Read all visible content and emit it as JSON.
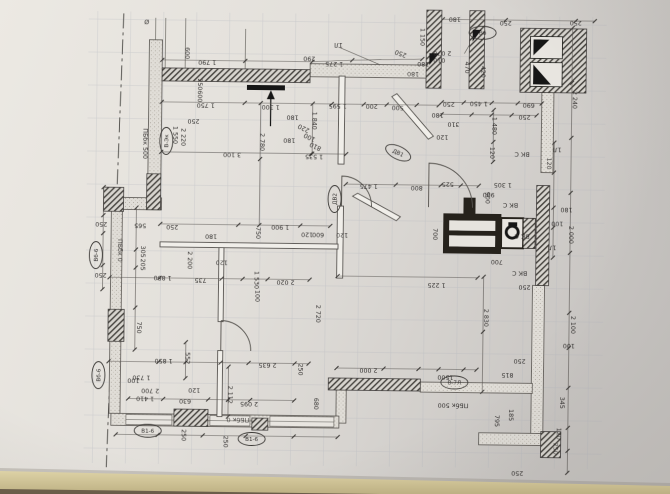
{
  "photo": {
    "paper_color": "#e4e1dc",
    "paper_light": "#efede8",
    "paper_shadow": "#c7c4c0",
    "table_color": "#d6cba0",
    "table_dark": "#b4a779",
    "table_edge_dark": "#5a4c3d",
    "ink": "#3c3a37",
    "grid_color": "#aeb4bb",
    "hatch_color": "#45423e"
  },
  "plan": {
    "dim_labels": [
      {
        "t": "Ø",
        "x": 144,
        "y": 22,
        "r": 180
      },
      {
        "t": "1 790",
        "x": 205,
        "y": 62,
        "r": 180
      },
      {
        "t": "600",
        "x": 183,
        "y": 55,
        "r": 90
      },
      {
        "t": "250",
        "x": 196,
        "y": 86,
        "r": 90
      },
      {
        "t": "600",
        "x": 196,
        "y": 98,
        "r": 90
      },
      {
        "t": "1 750",
        "x": 204,
        "y": 105,
        "r": 180
      },
      {
        "t": "250",
        "x": 192,
        "y": 121,
        "r": 180
      },
      {
        "t": "2 220",
        "x": 180,
        "y": 139,
        "r": 90
      },
      {
        "t": "1 550",
        "x": 172,
        "y": 137,
        "r": 90
      },
      {
        "t": "ПБбк 500",
        "x": 142,
        "y": 146,
        "r": 90
      },
      {
        "t": "290",
        "x": 307,
        "y": 57,
        "r": 180
      },
      {
        "t": "1 275",
        "x": 332,
        "y": 62,
        "r": 180
      },
      {
        "t": "1Л",
        "x": 336,
        "y": 43,
        "r": 180
      },
      {
        "t": "250",
        "x": 399,
        "y": 51,
        "r": 200
      },
      {
        "t": "1 150",
        "x": 418,
        "y": 36,
        "r": 90
      },
      {
        "t": "2 070",
        "x": 440,
        "y": 50,
        "r": 180
      },
      {
        "t": "010",
        "x": 437,
        "y": 57,
        "r": 180
      },
      {
        "t": "180",
        "x": 421,
        "y": 61,
        "r": 180
      },
      {
        "t": "180",
        "x": 411,
        "y": 71,
        "r": 180
      },
      {
        "t": "180",
        "x": 452,
        "y": 16,
        "r": 180
      },
      {
        "t": "250",
        "x": 503,
        "y": 19,
        "r": 180
      },
      {
        "t": "250",
        "x": 573,
        "y": 18,
        "r": 180
      },
      {
        "t": "470",
        "x": 463,
        "y": 66,
        "r": 90
      },
      {
        "t": "420",
        "x": 479,
        "y": 70,
        "r": 90
      },
      {
        "t": "180",
        "x": 436,
        "y": 112,
        "r": 180
      },
      {
        "t": "310",
        "x": 452,
        "y": 121,
        "r": 180
      },
      {
        "t": "120",
        "x": 441,
        "y": 134,
        "r": 180
      },
      {
        "t": "2 240",
        "x": 571,
        "y": 97,
        "r": 90
      },
      {
        "t": "690",
        "x": 527,
        "y": 101,
        "r": 180
      },
      {
        "t": "250",
        "x": 523,
        "y": 113,
        "r": 180
      },
      {
        "t": "1 450",
        "x": 477,
        "y": 100,
        "r": 180
      },
      {
        "t": "250",
        "x": 447,
        "y": 101,
        "r": 180
      },
      {
        "t": "1 480",
        "x": 491,
        "y": 124,
        "r": 90
      },
      {
        "t": "120",
        "x": 489,
        "y": 151,
        "r": 90
      },
      {
        "t": "1Л",
        "x": 556,
        "y": 145,
        "r": 180
      },
      {
        "t": "ВК С",
        "x": 521,
        "y": 150,
        "r": 180
      },
      {
        "t": "120",
        "x": 546,
        "y": 161,
        "r": 90
      },
      {
        "t": "1 595",
        "x": 336,
        "y": 104,
        "r": 180
      },
      {
        "t": "200",
        "x": 370,
        "y": 104,
        "r": 180
      },
      {
        "t": "500",
        "x": 396,
        "y": 105,
        "r": 180
      },
      {
        "t": "1 300",
        "x": 269,
        "y": 106,
        "r": 180
      },
      {
        "t": "180",
        "x": 291,
        "y": 116,
        "r": 180
      },
      {
        "t": "180",
        "x": 288,
        "y": 139,
        "r": 180
      },
      {
        "t": "2 780",
        "x": 259,
        "y": 143,
        "r": 90
      },
      {
        "t": "1 840",
        "x": 311,
        "y": 121,
        "r": 90
      },
      {
        "t": "3 100",
        "x": 231,
        "y": 154,
        "r": 180
      },
      {
        "t": "1 535",
        "x": 313,
        "y": 155,
        "r": 180
      },
      {
        "t": "220",
        "x": 303,
        "y": 127,
        "r": 205
      },
      {
        "t": "100",
        "x": 309,
        "y": 136,
        "r": 205
      },
      {
        "t": "810",
        "x": 315,
        "y": 145,
        "r": 205
      },
      {
        "t": "1 475",
        "x": 368,
        "y": 184,
        "r": 180
      },
      {
        "t": "800",
        "x": 416,
        "y": 185,
        "r": 180
      },
      {
        "t": "525",
        "x": 447,
        "y": 181,
        "r": 180
      },
      {
        "t": "900",
        "x": 485,
        "y": 196,
        "r": 90
      },
      {
        "t": "1 305",
        "x": 502,
        "y": 181,
        "r": 180
      },
      {
        "t": "900",
        "x": 488,
        "y": 191,
        "r": 180
      },
      {
        "t": "ВК С",
        "x": 510,
        "y": 201,
        "r": 180
      },
      {
        "t": "ВК С",
        "x": 522,
        "y": 232,
        "r": 180
      },
      {
        "t": "1Л",
        "x": 552,
        "y": 243,
        "r": 180
      },
      {
        "t": "180",
        "x": 566,
        "y": 205,
        "r": 180
      },
      {
        "t": "100",
        "x": 557,
        "y": 219,
        "r": 180
      },
      {
        "t": "2 000",
        "x": 569,
        "y": 232,
        "r": 90
      },
      {
        "t": "700",
        "x": 433,
        "y": 233,
        "r": 90
      },
      {
        "t": "700",
        "x": 497,
        "y": 258,
        "r": 180
      },
      {
        "t": "ВК С",
        "x": 520,
        "y": 269,
        "r": 180
      },
      {
        "t": "250",
        "x": 525,
        "y": 283,
        "r": 180
      },
      {
        "t": "1 900",
        "x": 280,
        "y": 226,
        "r": 180
      },
      {
        "t": "750",
        "x": 256,
        "y": 234,
        "r": 90
      },
      {
        "t": "120",
        "x": 307,
        "y": 233,
        "r": 180
      },
      {
        "t": "600",
        "x": 318,
        "y": 233,
        "r": 180
      },
      {
        "t": "120",
        "x": 342,
        "y": 233,
        "r": 180
      },
      {
        "t": "180",
        "x": 211,
        "y": 236,
        "r": 180
      },
      {
        "t": "250",
        "x": 101,
        "y": 225,
        "r": 180
      },
      {
        "t": "565",
        "x": 140,
        "y": 226,
        "r": 180
      },
      {
        "t": "250",
        "x": 172,
        "y": 227,
        "r": 180
      },
      {
        "t": "2 200",
        "x": 188,
        "y": 262,
        "r": 90
      },
      {
        "t": "305",
        "x": 141,
        "y": 254,
        "r": 90
      },
      {
        "t": "205",
        "x": 141,
        "y": 267,
        "r": 90
      },
      {
        "t": "ПБбк 0",
        "x": 118,
        "y": 253,
        "r": 90
      },
      {
        "t": "250",
        "x": 101,
        "y": 276,
        "r": 180
      },
      {
        "t": "1 850",
        "x": 163,
        "y": 278,
        "r": 180
      },
      {
        "t": "735",
        "x": 201,
        "y": 280,
        "r": 180
      },
      {
        "t": "120",
        "x": 222,
        "y": 262,
        "r": 180
      },
      {
        "t": "1 530",
        "x": 255,
        "y": 281,
        "r": 90
      },
      {
        "t": "2 020",
        "x": 286,
        "y": 281,
        "r": 180
      },
      {
        "t": "2 720",
        "x": 317,
        "y": 314,
        "r": 90
      },
      {
        "t": "750",
        "x": 138,
        "y": 330,
        "r": 90
      },
      {
        "t": "100",
        "x": 256,
        "y": 297,
        "r": 90
      },
      {
        "t": "1 850",
        "x": 165,
        "y": 361,
        "r": 180
      },
      {
        "t": "552",
        "x": 187,
        "y": 360,
        "r": 90
      },
      {
        "t": "2 635",
        "x": 269,
        "y": 364,
        "r": 180
      },
      {
        "t": "250",
        "x": 300,
        "y": 370,
        "r": 90
      },
      {
        "t": "100",
        "x": 135,
        "y": 381,
        "r": 180
      },
      {
        "t": "1 730",
        "x": 143,
        "y": 378,
        "r": 180
      },
      {
        "t": "2 700",
        "x": 152,
        "y": 391,
        "r": 180
      },
      {
        "t": "1 410",
        "x": 147,
        "y": 399,
        "r": 180
      },
      {
        "t": "120",
        "x": 196,
        "y": 390,
        "r": 180
      },
      {
        "t": "630",
        "x": 187,
        "y": 401,
        "r": 180
      },
      {
        "t": "2 112",
        "x": 230,
        "y": 396,
        "r": 90
      },
      {
        "t": "2 095",
        "x": 251,
        "y": 403,
        "r": 180
      },
      {
        "t": "680",
        "x": 316,
        "y": 404,
        "r": 90
      },
      {
        "t": "ПБбк 0",
        "x": 240,
        "y": 419,
        "r": 180
      },
      {
        "t": "250",
        "x": 184,
        "y": 437,
        "r": 90
      },
      {
        "t": "250",
        "x": 226,
        "y": 443,
        "r": 90
      },
      {
        "t": "1 225",
        "x": 437,
        "y": 282,
        "r": 180
      },
      {
        "t": "2 830",
        "x": 485,
        "y": 316,
        "r": 90
      },
      {
        "t": "2 000",
        "x": 370,
        "y": 368,
        "r": 180
      },
      {
        "t": "1500",
        "x": 447,
        "y": 374,
        "r": 180
      },
      {
        "t": "815",
        "x": 509,
        "y": 371,
        "r": 180
      },
      {
        "t": "250",
        "x": 521,
        "y": 357,
        "r": 180
      },
      {
        "t": "ПБбк 500",
        "x": 455,
        "y": 402,
        "r": 180
      },
      {
        "t": "795",
        "x": 497,
        "y": 419,
        "r": 90
      },
      {
        "t": "185",
        "x": 511,
        "y": 413,
        "r": 90
      },
      {
        "t": "2 100",
        "x": 572,
        "y": 322,
        "r": 90
      },
      {
        "t": "100",
        "x": 570,
        "y": 341,
        "r": 180
      },
      {
        "t": "345",
        "x": 562,
        "y": 400,
        "r": 90
      },
      {
        "t": "120",
        "x": 559,
        "y": 431,
        "r": 90
      },
      {
        "t": "250",
        "x": 556,
        "y": 446,
        "r": 90
      },
      {
        "t": "250",
        "x": 520,
        "y": 469,
        "r": 180
      }
    ],
    "axis_tags": [
      {
        "t": "В-Эк",
        "x": 165,
        "y": 143,
        "r": 90
      },
      {
        "t": "Вб",
        "x": 480,
        "y": 31,
        "r": 180
      },
      {
        "t": "ДВ1",
        "x": 397,
        "y": 152,
        "r": 205
      },
      {
        "t": "ДВ2",
        "x": 334,
        "y": 199,
        "r": 90
      },
      {
        "t": "Вб-6",
        "x": 96,
        "y": 258,
        "r": 90
      },
      {
        "t": "Вб-6",
        "x": 100,
        "y": 378,
        "r": 90
      },
      {
        "t": "В1-6",
        "x": 150,
        "y": 433,
        "r": 180
      },
      {
        "t": "В1-6",
        "x": 254,
        "y": 440,
        "r": 180
      },
      {
        "t": "В-7Л",
        "x": 456,
        "y": 381,
        "r": 180
      }
    ],
    "symbols": [
      "entrance-arrow",
      "vent-shaft",
      "wc-fixture",
      "door-swing",
      "axis-dash-line"
    ]
  }
}
